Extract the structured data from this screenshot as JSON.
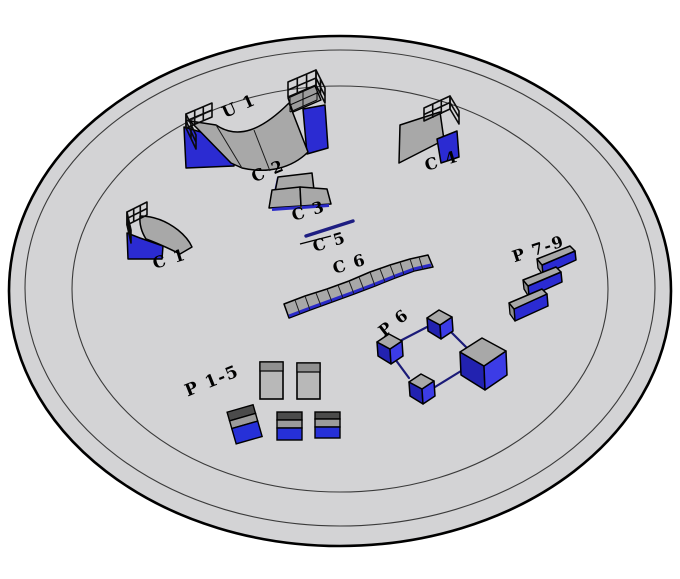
{
  "scene": {
    "title": "skatepark-3d-layout-render",
    "background": "#ffffff",
    "ground": {
      "fill": "#d3d3d5",
      "outline": "#000000",
      "ring_line": "#3a3a3a"
    },
    "palette": {
      "obstacle_top_gray": "#a8a8a8",
      "obstacle_side_blue": "#2b2bd2",
      "obstacle_side_blue_light": "#3c3ce6",
      "obstacle_side_blue_dark": "#2222b0",
      "rail_navy": "#1b1b78",
      "box_dark_band": "#4b4b4b",
      "box_gray_band": "#9b9b9b",
      "box_blue_band": "#2630d8",
      "tall_box_gray": "#b8b8b8",
      "label_color": "#000000"
    }
  },
  "obstacles": [
    {
      "id": "u1",
      "label": "U 1",
      "type": "halfpipe-with-platform-railings"
    },
    {
      "id": "c1",
      "label": "C 1",
      "type": "quarter-pipe-with-railing"
    },
    {
      "id": "c2",
      "label": "C 2",
      "type": "bank-panel"
    },
    {
      "id": "c3",
      "label": "C 3",
      "type": "double-bank"
    },
    {
      "id": "c4",
      "label": "C 4",
      "type": "bank-ramp-with-railing"
    },
    {
      "id": "c5",
      "label": "C 5",
      "type": "flat-rail"
    },
    {
      "id": "c6",
      "label": "C 6",
      "type": "segmented-ledge"
    },
    {
      "id": "p6",
      "label": "P 6",
      "type": "pedestals-connected-by-rails"
    },
    {
      "id": "p15",
      "label": "P 1-5",
      "type": "box-group"
    },
    {
      "id": "p79",
      "label": "P 7-9",
      "type": "three-parallel-ledges"
    }
  ]
}
